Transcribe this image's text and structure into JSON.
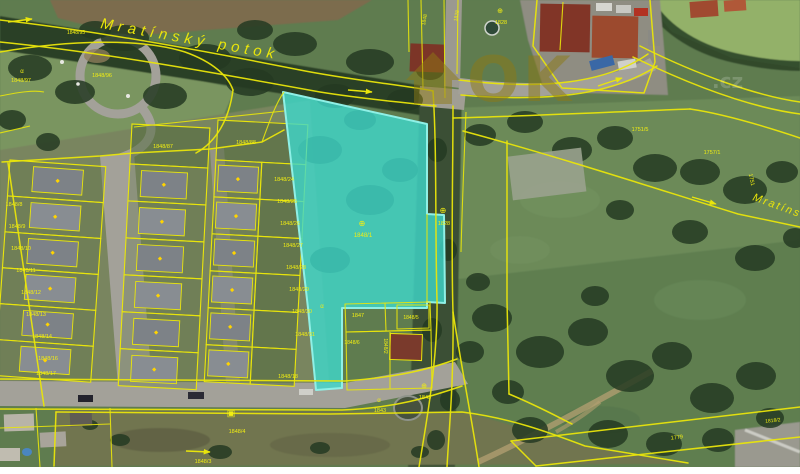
{
  "map": {
    "stream_label": "Mratínský potok",
    "watermark_text": "OK",
    "watermark_suffix": ".cz",
    "highlight_color": "#3ed8cc",
    "parcel_line_color": "#e9e50b",
    "highlighted_parcel": {
      "label": "1848/1"
    },
    "labels": [
      {
        "t": "1848/95",
        "x": 76,
        "y": 34,
        "s": 5
      },
      {
        "t": "α",
        "x": 22,
        "y": 73,
        "s": 6
      },
      {
        "t": "1848/97",
        "x": 21,
        "y": 82,
        "s": 5.5
      },
      {
        "t": "1848/96",
        "x": 102,
        "y": 77,
        "s": 5.5
      },
      {
        "t": "1848/87",
        "x": 163,
        "y": 148,
        "s": 5.5
      },
      {
        "t": "1848/88",
        "x": 246,
        "y": 144,
        "s": 5.5
      },
      {
        "t": "1848/8",
        "x": 14,
        "y": 206,
        "s": 5.5
      },
      {
        "t": "1848/9",
        "x": 17,
        "y": 228,
        "s": 5.5
      },
      {
        "t": "1848/10",
        "x": 21,
        "y": 250,
        "s": 5.5
      },
      {
        "t": "1848/11",
        "x": 26,
        "y": 272,
        "s": 5.5
      },
      {
        "t": "1848/12",
        "x": 31,
        "y": 294,
        "s": 5.5
      },
      {
        "t": "1848/13",
        "x": 36,
        "y": 316,
        "s": 5.5
      },
      {
        "t": "1848/14",
        "x": 42,
        "y": 338,
        "s": 5.5
      },
      {
        "t": "1848/16",
        "x": 48,
        "y": 360,
        "s": 5.5
      },
      {
        "t": "1848/17",
        "x": 46,
        "y": 375,
        "s": 5.5
      },
      {
        "t": "1848/24",
        "x": 284,
        "y": 181,
        "s": 5.5
      },
      {
        "t": "1848/25",
        "x": 287,
        "y": 203,
        "s": 5.5
      },
      {
        "t": "1848/26",
        "x": 290,
        "y": 225,
        "s": 5.5
      },
      {
        "t": "1848/27",
        "x": 293,
        "y": 247,
        "s": 5.5
      },
      {
        "t": "1848/28",
        "x": 296,
        "y": 269,
        "s": 5.5
      },
      {
        "t": "1848/29",
        "x": 299,
        "y": 291,
        "s": 5.5
      },
      {
        "t": "1848/30",
        "x": 302,
        "y": 313,
        "s": 5.5
      },
      {
        "t": "1848/31",
        "x": 305,
        "y": 336,
        "s": 5.5
      },
      {
        "t": "1848/18",
        "x": 288,
        "y": 378,
        "s": 5.5
      },
      {
        "t": "⊕",
        "x": 362,
        "y": 226,
        "s": 8
      },
      {
        "t": "1848/1",
        "x": 363,
        "y": 237,
        "s": 6
      },
      {
        "t": "α",
        "x": 322,
        "y": 308,
        "s": 6
      },
      {
        "t": "1847",
        "x": 358,
        "y": 317,
        "s": 5.5
      },
      {
        "t": "1848/5",
        "x": 411,
        "y": 319,
        "s": 5
      },
      {
        "t": "1848/6",
        "x": 352,
        "y": 344,
        "s": 5
      },
      {
        "t": "1848/2",
        "x": 384,
        "y": 346,
        "s": 5,
        "r": 90
      },
      {
        "t": "⊕",
        "x": 443,
        "y": 213,
        "s": 8
      },
      {
        "t": "1828",
        "x": 444,
        "y": 225,
        "s": 5.5
      },
      {
        "t": "1848",
        "x": 426,
        "y": 20,
        "s": 5,
        "r": -80
      },
      {
        "t": "1828",
        "x": 458,
        "y": 16,
        "s": 5,
        "r": -80
      },
      {
        "t": "⊕",
        "x": 500,
        "y": 13,
        "s": 7
      },
      {
        "t": "1828",
        "x": 501,
        "y": 24,
        "s": 5.5
      },
      {
        "t": "1751/5",
        "x": 640,
        "y": 131,
        "s": 5.5
      },
      {
        "t": "1757/1",
        "x": 712,
        "y": 154,
        "s": 5.5
      },
      {
        "t": "1751",
        "x": 750,
        "y": 180,
        "s": 5.5,
        "r": 78
      },
      {
        "t": "α",
        "x": 379,
        "y": 402,
        "s": 6
      },
      {
        "t": "1843",
        "x": 380,
        "y": 412,
        "s": 5.5
      },
      {
        "t": "⊕",
        "x": 424,
        "y": 388,
        "s": 7
      },
      {
        "t": "1843",
        "x": 425,
        "y": 399,
        "s": 5.5
      },
      {
        "t": "▣",
        "x": 231,
        "y": 416,
        "s": 9
      },
      {
        "t": "1848/4",
        "x": 237,
        "y": 433,
        "s": 5.5
      },
      {
        "t": "1848/3",
        "x": 203,
        "y": 463,
        "s": 5.5
      },
      {
        "t": "1779",
        "x": 677,
        "y": 439,
        "s": 5.5,
        "r": -6
      },
      {
        "t": "1818/2",
        "x": 773,
        "y": 422,
        "s": 5,
        "r": -6
      }
    ]
  }
}
